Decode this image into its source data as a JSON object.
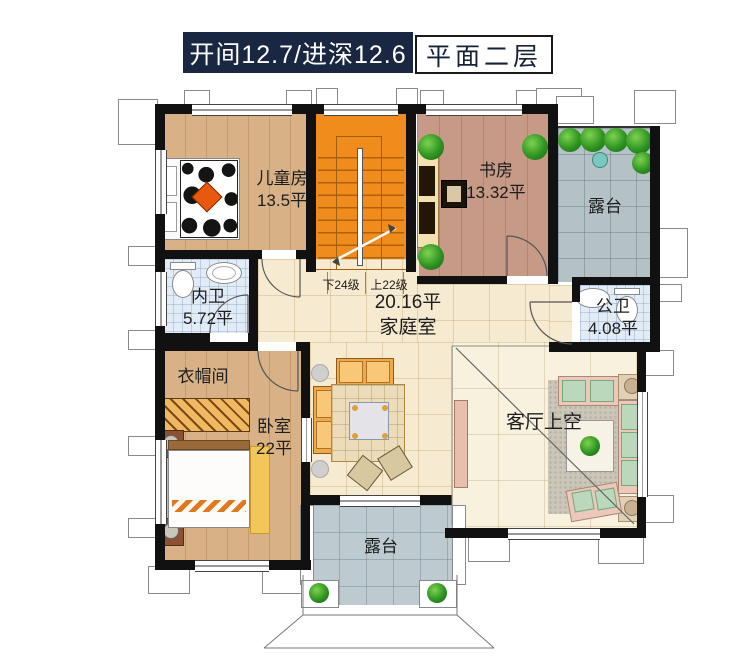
{
  "header": {
    "dimensions": "开间12.7/进深12.6",
    "floor": "平面二层"
  },
  "rooms": {
    "children": {
      "name": "儿童房",
      "area": "13.5平"
    },
    "study": {
      "name": "书房",
      "area": "13.32平"
    },
    "terrace_top": {
      "name": "露台"
    },
    "bath_inner": {
      "name": "内卫",
      "area": "5.72平"
    },
    "bath_public": {
      "name": "公卫",
      "area": "4.08平"
    },
    "family": {
      "area": "20.16平",
      "name": "家庭室"
    },
    "cloak": {
      "name": "衣帽间"
    },
    "bedroom": {
      "name": "卧室",
      "area": "22平"
    },
    "living_void": {
      "name": "客厅上空"
    },
    "terrace_bottom": {
      "name": "露台"
    }
  },
  "stairs": {
    "down": "下24级",
    "up": "上22级"
  },
  "colors": {
    "title_bg": "#1a2742",
    "wall": "#111111",
    "stairs": "#ef8c1c",
    "wood_light": "#d8b286",
    "wood_study": "#c69a86",
    "tile_cream": "#f6ead0",
    "tile_void": "#f8f1de",
    "terrace": "#b4c1c5",
    "terrace_bottom": "#bdcad0",
    "bath": "#e2ecf7"
  }
}
